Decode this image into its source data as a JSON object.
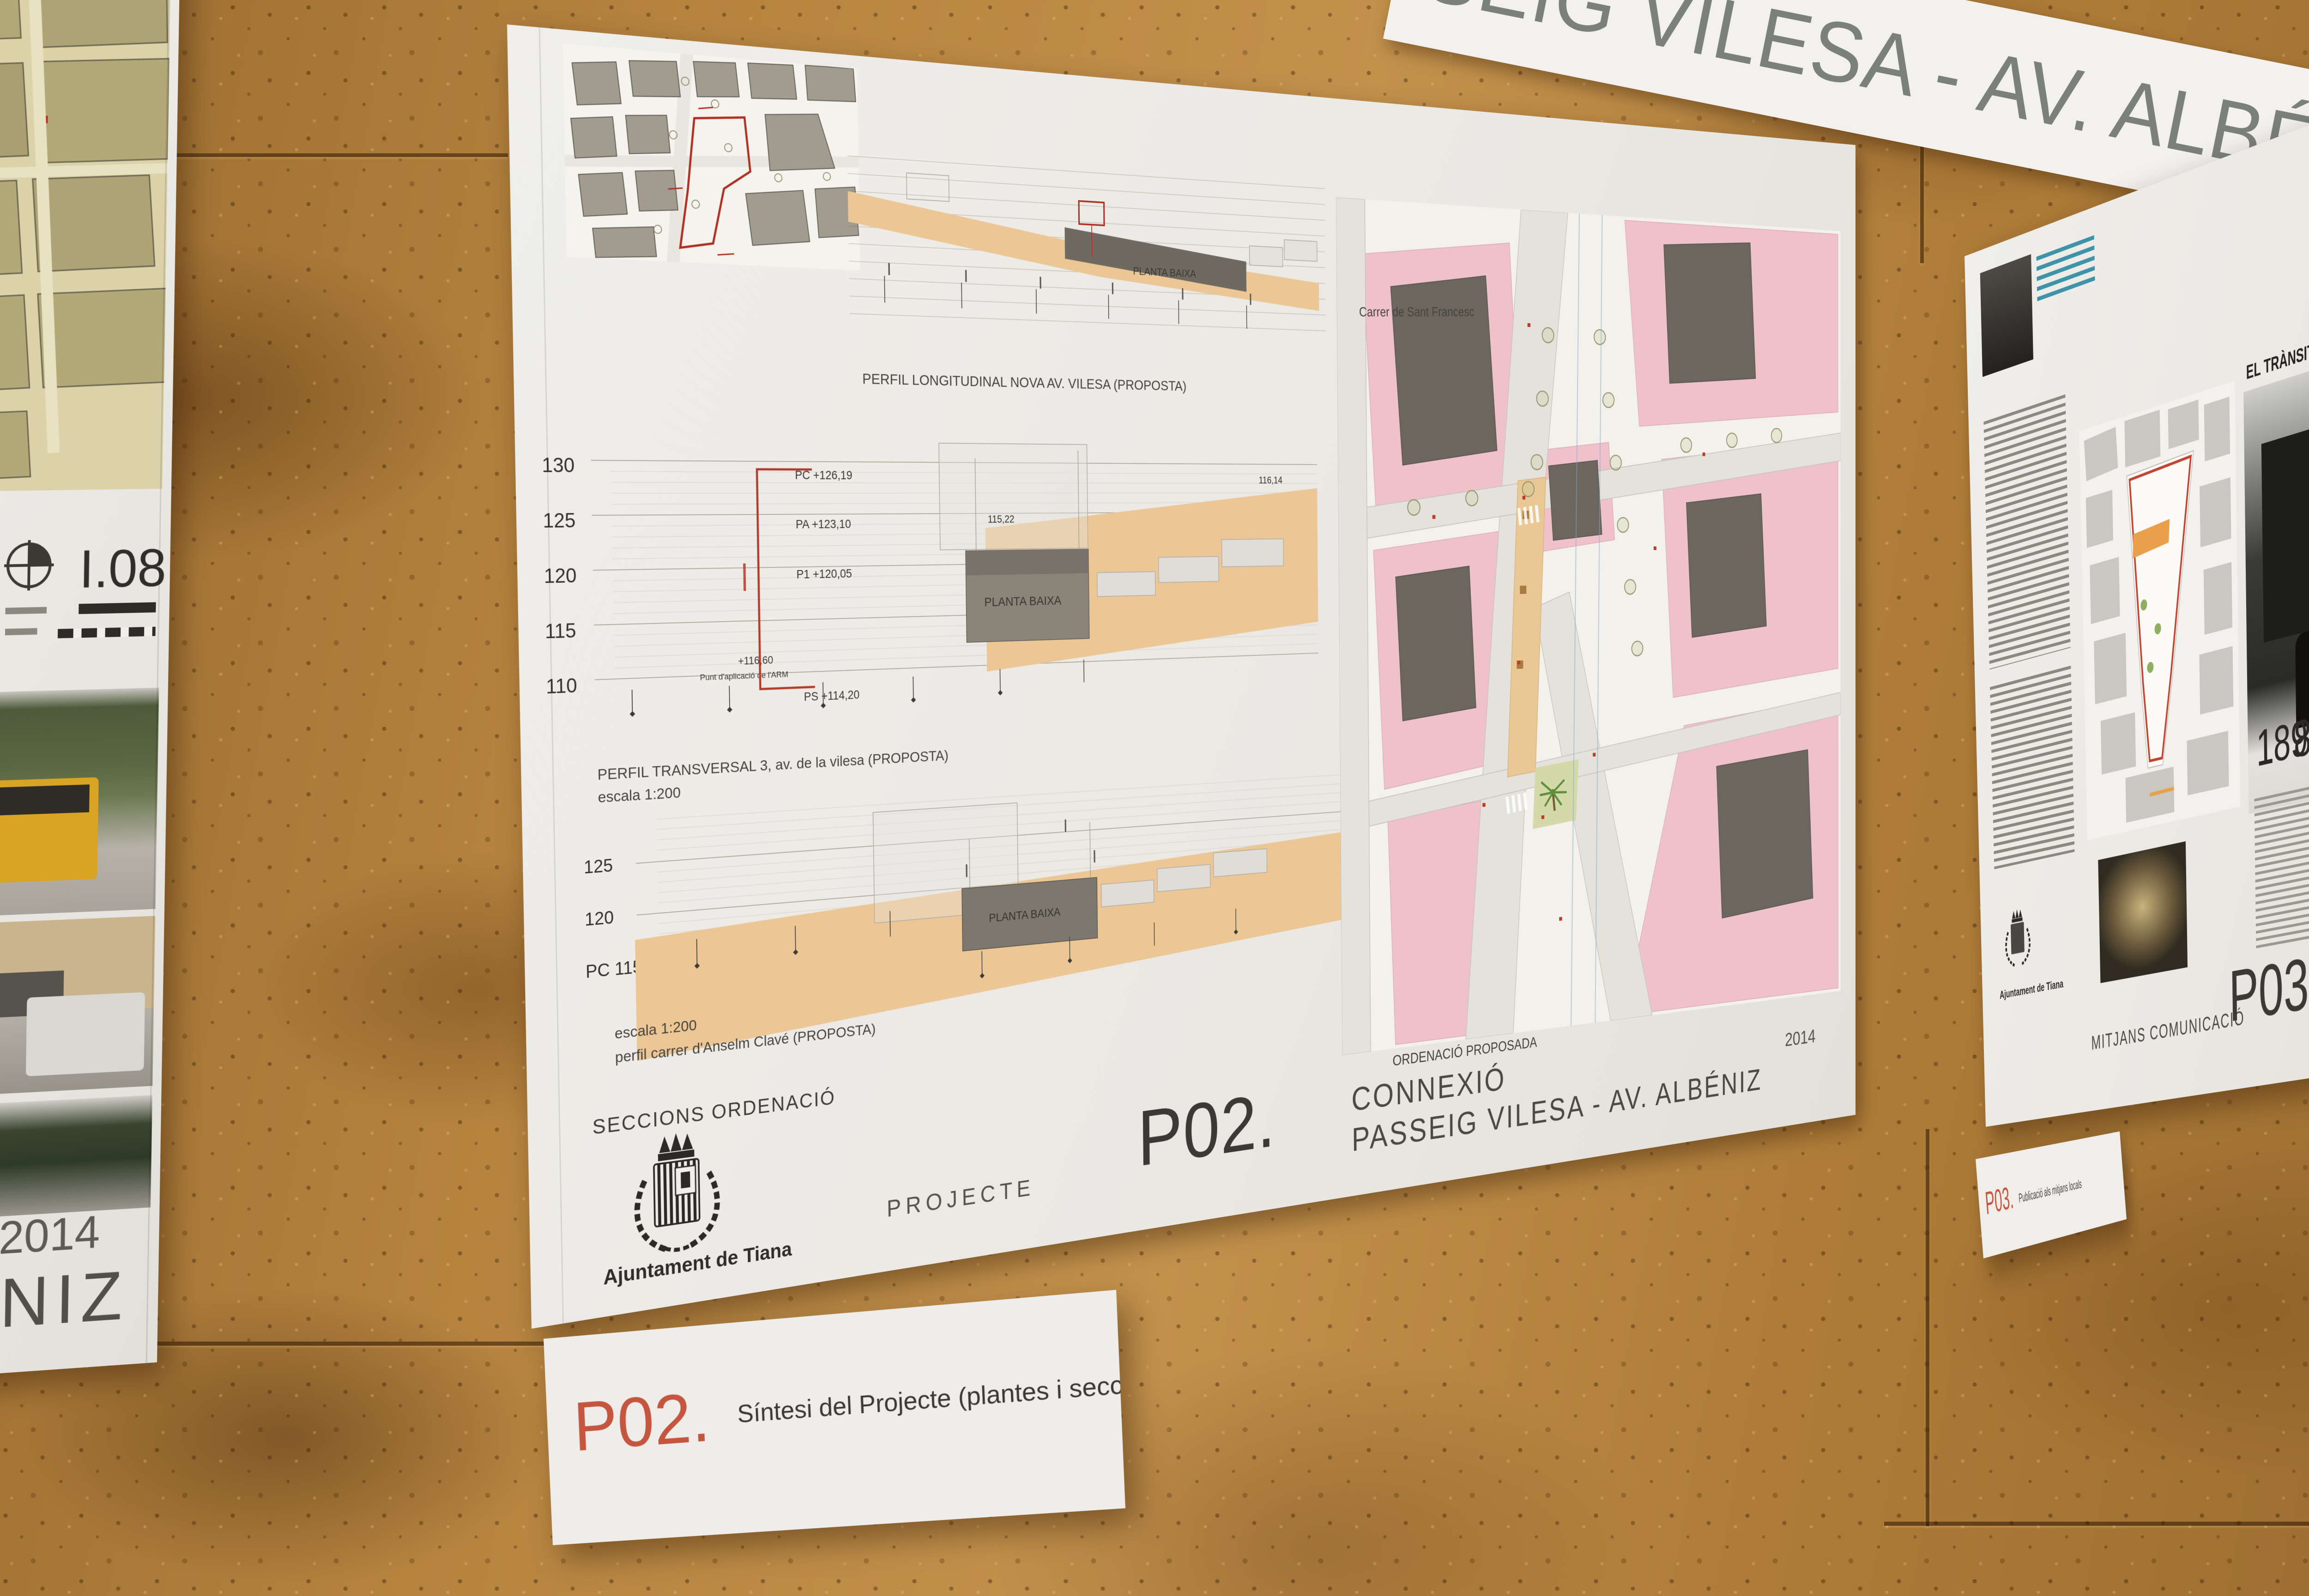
{
  "banner": {
    "text": "SEIG VILESA - AV. ALBÉNIZ"
  },
  "left_poster": {
    "sheet_code": "I.08",
    "year": "2014",
    "street_name_fragment": "ALBÉNIZ"
  },
  "main_poster": {
    "code": "P02.",
    "title_line1": "CONNEXIÓ",
    "title_line2": "PASSEIG VILESA - AV. ALBÉNIZ",
    "year": "2014",
    "phase_label": "PROJECTE",
    "sheet_label": "SECCIONS ORDENACIÓ",
    "organization": "Ajuntament de Tiana",
    "plan": {
      "caption": "ORDENACIÓ PROPOSADA",
      "street_label": "Carrer de Sant Francesc"
    },
    "profiles": {
      "longitudinal": {
        "caption": "PERFIL LONGITUDINAL NOVA AV. VILESA (PROPOSTA)",
        "box_label": "PLANTA BAIXA"
      },
      "transversal": {
        "caption": "PERFIL TRANSVERSAL 3, av. de la vilesa (PROPOSTA)",
        "scale": "escala 1:200",
        "box_label": "PLANTA BAIXA",
        "elevations": [
          "130",
          "125",
          "120",
          "115",
          "110"
        ],
        "levels": [
          "PC +126,19",
          "PA +123,10",
          "P1 +120,05",
          "PS +114,20"
        ],
        "arm_value": "+116,60",
        "arm_note": "Punt d'aplicació de l'ARM",
        "ground_start": "115,22",
        "ground_end": "116,14"
      },
      "anselm": {
        "scale": "escala 1:200",
        "caption": "perfil carrer d'Anselm Clavé (PROPOSTA)",
        "box_label": "PLANTA BAIXA",
        "elevations": [
          "125",
          "120",
          "PC 115"
        ]
      }
    }
  },
  "p02_card": {
    "code": "P02.",
    "text": "Síntesi del Projecte (plantes i seccions)"
  },
  "p03_poster": {
    "question_line1": "a quins mitjans",
    "question_line2": "ha estat publicat",
    "headline": "EL TRÀNSIT A TIANA",
    "years": [
      "1898",
      "1910",
      "1932"
    ],
    "footer_label": "MITJANS COMUNICACIÓ",
    "code": "P03.",
    "title_line1": "CONNEXIÓ",
    "title_line2": "PASSEIG VILESA",
    "organization": "Ajuntament de Tiana"
  },
  "p03_card": {
    "code": "P03.",
    "text": "Publicació als mitjans locals"
  },
  "colors": {
    "accent_red": "#c0432f",
    "card_code": "#c4563f",
    "cork": "#b2813f",
    "pink": "#efc2ca",
    "tan": "#ecc795"
  }
}
